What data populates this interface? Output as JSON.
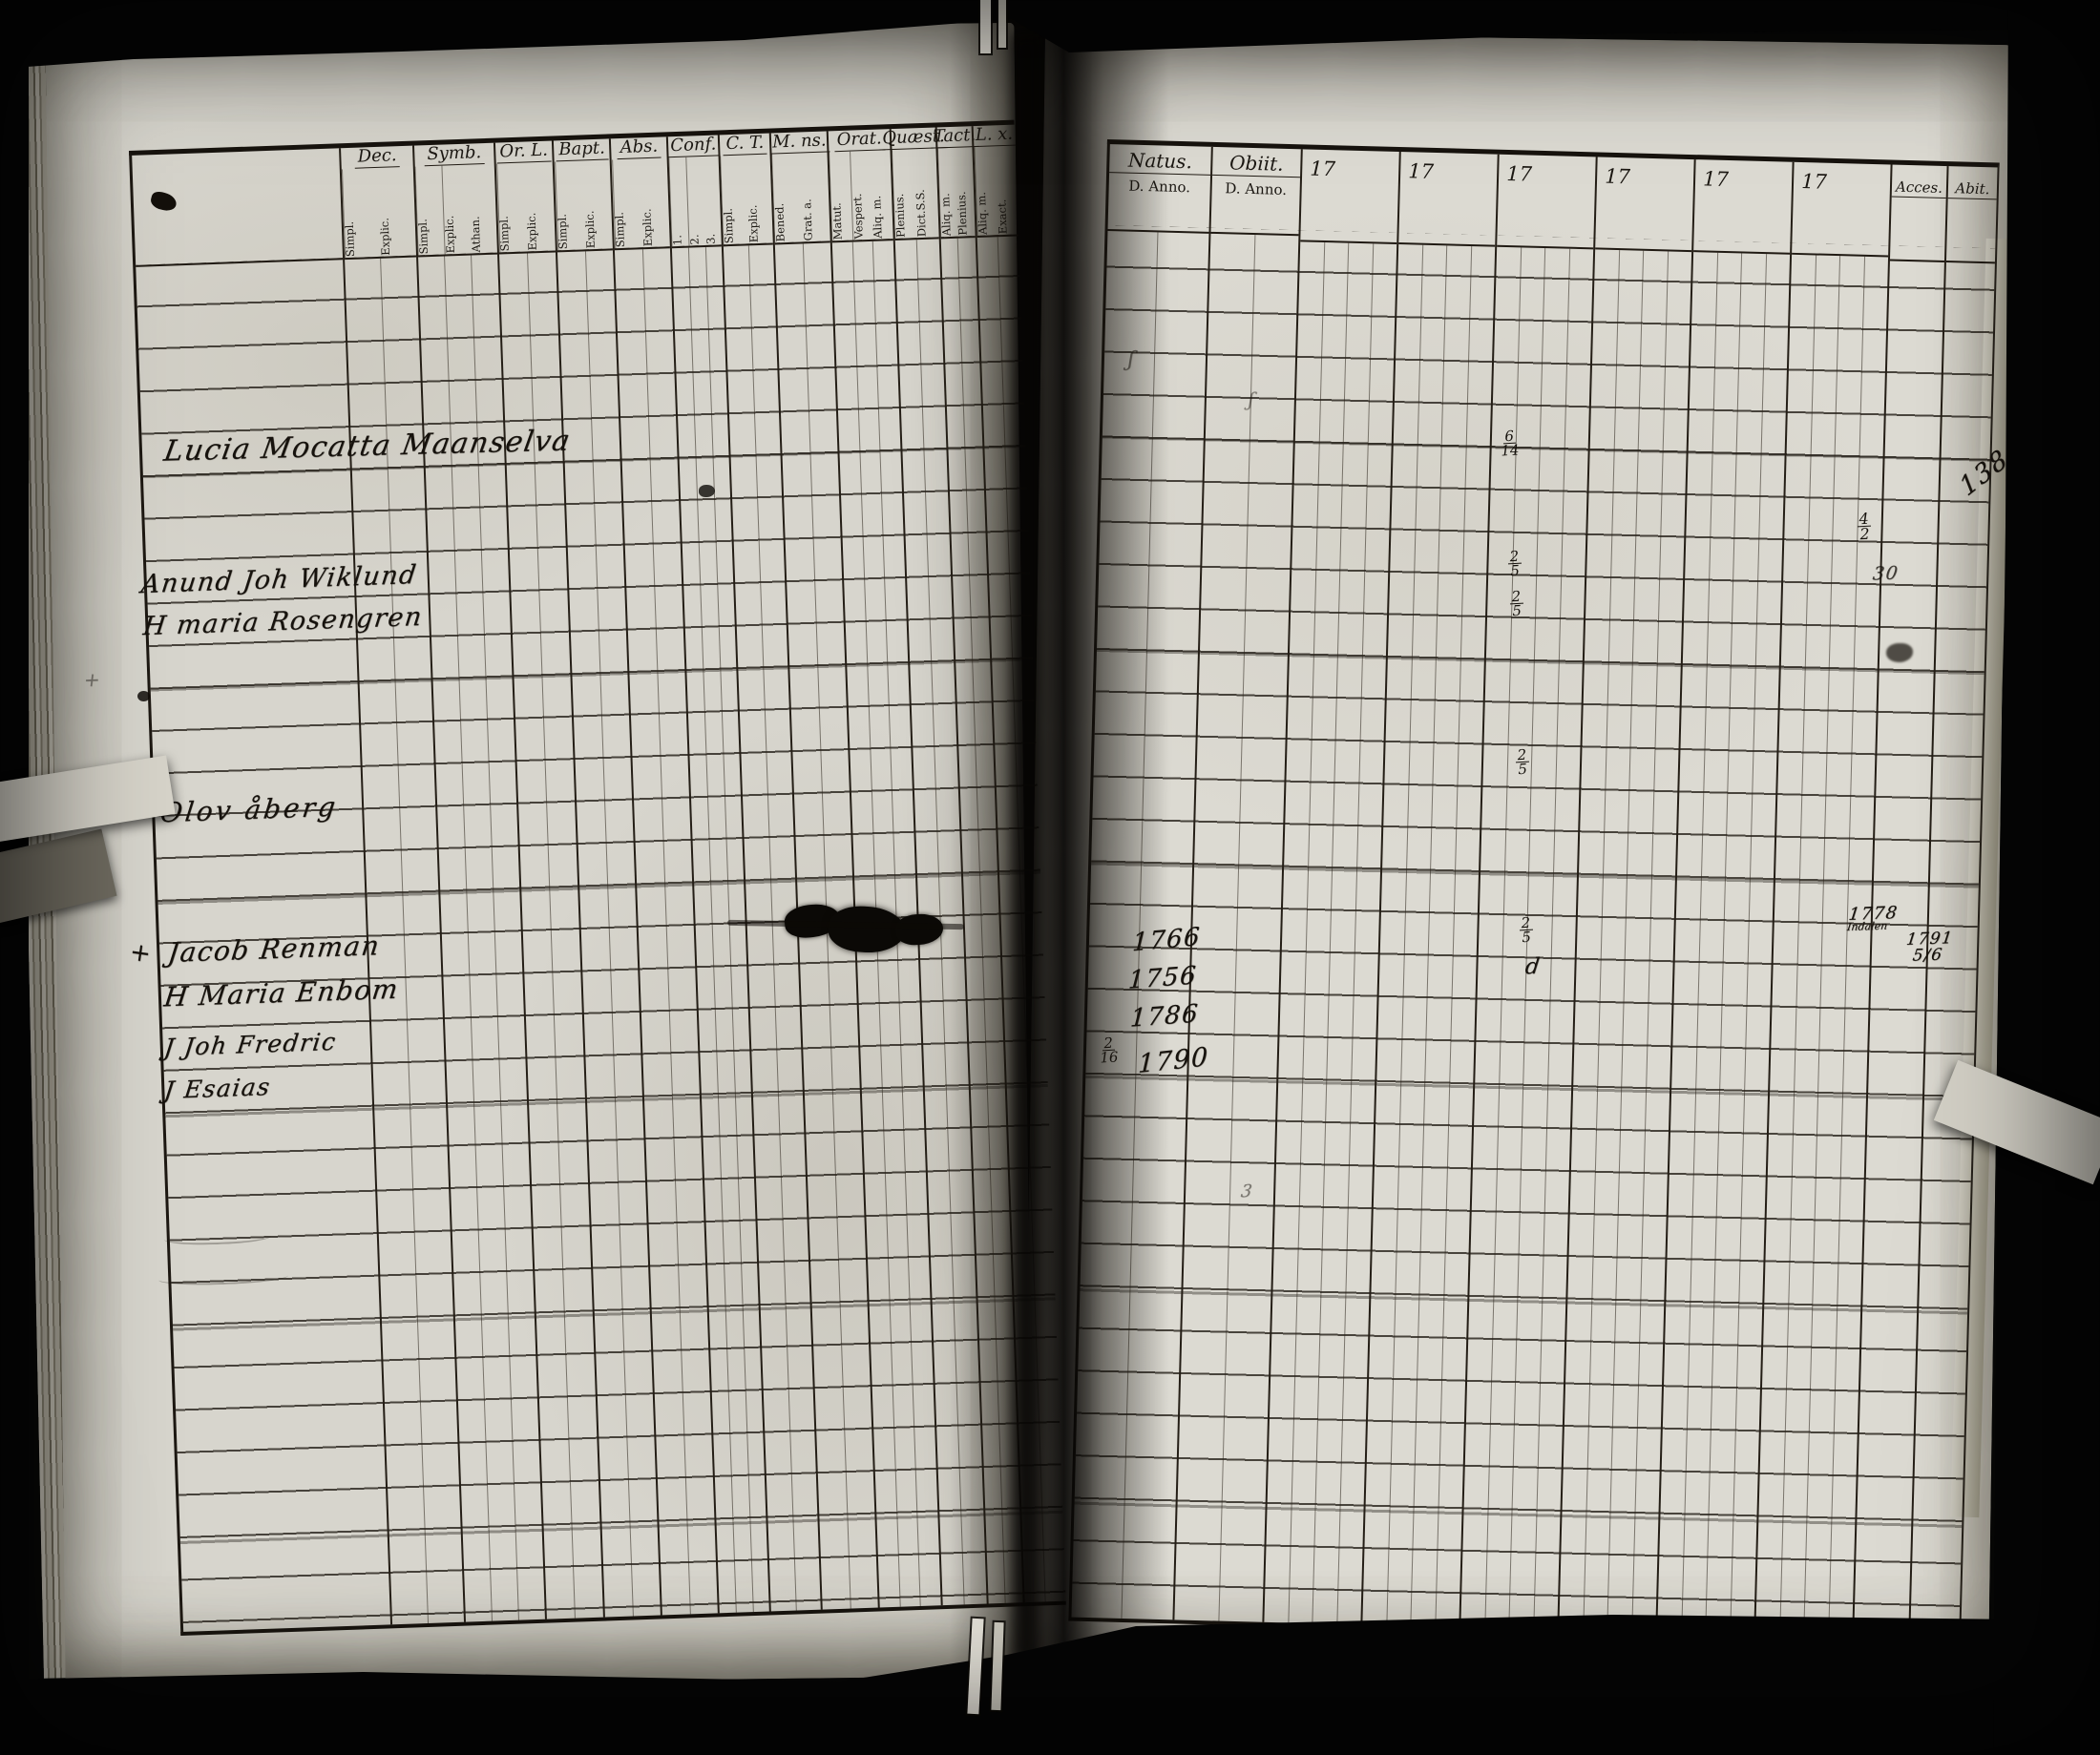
{
  "left_page": {
    "header_groups": [
      {
        "label": "Dec.",
        "subs": [
          "Simpl.",
          "Explic."
        ]
      },
      {
        "label": "Symb.",
        "subs": [
          "Simpl.",
          "Explic.",
          "Athan."
        ]
      },
      {
        "label": "Or. L.",
        "subs": [
          "Simpl.",
          "Explic."
        ]
      },
      {
        "label": "Bapt.",
        "subs": [
          "Simpl.",
          "Explic."
        ]
      },
      {
        "label": "Abs.",
        "subs": [
          "Simpl.",
          "Explic."
        ]
      },
      {
        "label": "Conf.",
        "subs": [
          "1.",
          "2.",
          "3."
        ]
      },
      {
        "label": "C. T.",
        "subs": [
          "Simpl.",
          "Explic."
        ]
      },
      {
        "label": "M. ns.",
        "subs": [
          "Bened.",
          "Grat. a."
        ]
      },
      {
        "label": "Orat.",
        "subs": [
          "Matut.",
          "Vespert.",
          "Aliq. m."
        ]
      },
      {
        "label": "Quæst.",
        "subs": [
          "Plenius.",
          "Dict.S.S."
        ]
      },
      {
        "label": "Tact.",
        "subs": [
          "Aliq. m.",
          "Plenius."
        ]
      },
      {
        "label": "L. x.",
        "subs": [
          "Aliq. m.",
          "Exact."
        ]
      }
    ],
    "entries": [
      {
        "name": "Lucia Mocatta Maanselva"
      },
      {
        "name": "Anund Joh Wiklund"
      },
      {
        "name": "H maria Rosengren"
      },
      {
        "name": "Olov åberg"
      },
      {
        "name": "Jacob Renman"
      },
      {
        "name": "H Maria Enbom"
      },
      {
        "name": "J Joh Fredric"
      },
      {
        "name": "J Esaias"
      }
    ],
    "margin_cross": "+",
    "margin_cross_faint": "+"
  },
  "right_page": {
    "natus_label": "Natus.",
    "obiit_label": "Obiit.",
    "d_anno": "D. Anno.",
    "year_prefix": "17",
    "acces_label": "Acces.",
    "abiit_label": "Abit.",
    "natus_years": [
      {
        "year": "1766"
      },
      {
        "year": "1756"
      },
      {
        "year": "1786"
      },
      {
        "year": "1790",
        "day_num": "2",
        "day_den": "16"
      }
    ],
    "date_marks": [
      {
        "num": "6",
        "den": "14"
      },
      {
        "num": "2",
        "den": "5"
      },
      {
        "num": "2",
        "den": "5"
      },
      {
        "num": "2",
        "den": "5"
      },
      {
        "num": "2",
        "den": "5"
      },
      {
        "letter": "d"
      }
    ],
    "acces_note": {
      "year": "1778",
      "place": "Indalen"
    },
    "abiit_note": {
      "year": "1791",
      "num": "5",
      "den": "6"
    },
    "margin_marks": {
      "frac_num": "4",
      "frac_den": "2",
      "value": "30",
      "mark3": "3"
    },
    "folio_number": "138",
    "stray_marks": [
      "ʃ",
      "ʃ"
    ]
  }
}
